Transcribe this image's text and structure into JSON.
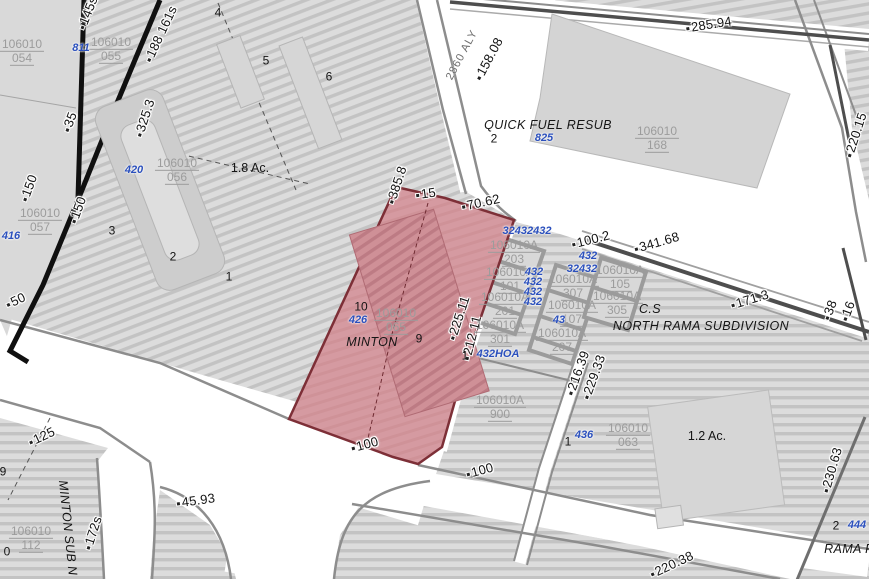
{
  "map": {
    "colors": {
      "selected_fill": "#d59aa1",
      "selected_hatch": "#c8888f",
      "selected_border": "#7d2f37",
      "parcel_fill": "#dcdcdc",
      "hatch_line": "#c3c3c3",
      "building_fill": "#d4d4d4",
      "road_white": "#ffffff",
      "road_casing": "#8d8d8d",
      "road_core": "#4e4e4e",
      "boundary_black": "#101010",
      "address_text": "#2b50bd",
      "parcel_id_text": "#9c9c9c",
      "dimension_text": "#141414"
    },
    "selected_parcel": {
      "parcel_id": "106010 065",
      "subdivision": "MINTON",
      "address": "426"
    },
    "labels": [
      {
        "name": "dim-145s",
        "type": "dim",
        "text": "145s",
        "x": 88,
        "y": 13,
        "rot": -68
      },
      {
        "name": "dim-188-161s",
        "type": "dim",
        "text": "188 161s",
        "x": 161,
        "y": 34,
        "rot": -65
      },
      {
        "name": "dim-325-3",
        "type": "dim",
        "text": "325.3",
        "x": 145,
        "y": 118,
        "rot": -72
      },
      {
        "name": "dim-35",
        "type": "dim",
        "text": "35",
        "x": 70,
        "y": 122,
        "rot": -70
      },
      {
        "name": "dim-150-a",
        "type": "dim",
        "text": "150",
        "x": 29,
        "y": 188,
        "rot": -70
      },
      {
        "name": "dim-150-b",
        "type": "dim",
        "text": "150",
        "x": 78,
        "y": 210,
        "rot": -70
      },
      {
        "name": "dim-50",
        "type": "dim",
        "text": "50",
        "x": 16,
        "y": 301,
        "rot": -25
      },
      {
        "name": "dim-125",
        "type": "dim",
        "text": "125",
        "x": 42,
        "y": 437,
        "rot": -25
      },
      {
        "name": "dim-45-93",
        "type": "dim",
        "text": "45.93",
        "x": 196,
        "y": 501,
        "rot": -8
      },
      {
        "name": "dim-172s",
        "type": "dim",
        "text": "172s",
        "x": 93,
        "y": 533,
        "rot": -72
      },
      {
        "name": "dim-385-8",
        "type": "dim",
        "text": "385.8",
        "x": 397,
        "y": 185,
        "rot": -72
      },
      {
        "name": "dim-15",
        "type": "dim",
        "text": "15",
        "x": 426,
        "y": 194,
        "rot": -8
      },
      {
        "name": "dim-70-62",
        "type": "dim",
        "text": "70.62",
        "x": 481,
        "y": 203,
        "rot": -12
      },
      {
        "name": "dim-225-11",
        "type": "dim",
        "text": "225.11",
        "x": 459,
        "y": 318,
        "rot": -72
      },
      {
        "name": "dim-212-11",
        "type": "dim",
        "text": "212.11",
        "x": 472,
        "y": 338,
        "rot": -76
      },
      {
        "name": "dim-100-red",
        "type": "dim",
        "text": "100",
        "x": 365,
        "y": 445,
        "rot": -15
      },
      {
        "name": "dim-100-b",
        "type": "dim",
        "text": "100",
        "x": 480,
        "y": 471,
        "rot": -15
      },
      {
        "name": "dim-158-08",
        "type": "dim",
        "text": "158.08",
        "x": 489,
        "y": 59,
        "rot": -62
      },
      {
        "name": "dim-285-94",
        "type": "dim",
        "text": "285.94",
        "x": 709,
        "y": 25,
        "rot": -9
      },
      {
        "name": "dim-220-15",
        "type": "dim",
        "text": "220.15",
        "x": 856,
        "y": 135,
        "rot": -72
      },
      {
        "name": "dim-100-2",
        "type": "dim",
        "text": "100.2",
        "x": 591,
        "y": 240,
        "rot": -14
      },
      {
        "name": "dim-341-68",
        "type": "dim",
        "text": "341.68",
        "x": 657,
        "y": 243,
        "rot": -16
      },
      {
        "name": "dim-171-3",
        "type": "dim",
        "text": "171.3",
        "x": 750,
        "y": 300,
        "rot": -17
      },
      {
        "name": "dim-38",
        "type": "dim",
        "text": "38",
        "x": 830,
        "y": 310,
        "rot": -70
      },
      {
        "name": "dim-16",
        "type": "dim",
        "text": "16",
        "x": 848,
        "y": 311,
        "rot": -70
      },
      {
        "name": "dim-216-39",
        "type": "dim",
        "text": "216.39",
        "x": 578,
        "y": 373,
        "rot": -70
      },
      {
        "name": "dim-229-33",
        "type": "dim",
        "text": "229.33",
        "x": 594,
        "y": 377,
        "rot": -70
      },
      {
        "name": "dim-230-63",
        "type": "dim",
        "text": "230.63",
        "x": 832,
        "y": 470,
        "rot": -74
      },
      {
        "name": "dim-220-38",
        "type": "dim",
        "text": "220.38",
        "x": 672,
        "y": 565,
        "rot": -25
      },
      {
        "name": "parcel-id-054",
        "type": "parcel-id",
        "text": "106010",
        "text2": "054",
        "x": 22,
        "y": 52,
        "rot": 0
      },
      {
        "name": "parcel-id-055",
        "type": "parcel-id",
        "text": "106010",
        "text2": "055",
        "x": 111,
        "y": 50,
        "rot": 0
      },
      {
        "name": "parcel-id-057",
        "type": "parcel-id",
        "text": "106010",
        "text2": "057",
        "x": 40,
        "y": 221,
        "rot": 0
      },
      {
        "name": "parcel-id-056",
        "type": "parcel-id",
        "text": "106010",
        "text2": "056",
        "x": 177,
        "y": 171,
        "rot": 0
      },
      {
        "name": "parcel-id-065-selected",
        "type": "parcel-id",
        "text": "106010",
        "text2": "065",
        "x": 396,
        "y": 321,
        "rot": 0
      },
      {
        "name": "parcel-id-168",
        "type": "parcel-id",
        "text": "106010",
        "text2": "168",
        "x": 657,
        "y": 139,
        "rot": 0
      },
      {
        "name": "parcel-id-063",
        "type": "parcel-id",
        "text": "106010",
        "text2": "063",
        "x": 628,
        "y": 436,
        "rot": 0
      },
      {
        "name": "parcel-id-112",
        "type": "parcel-id",
        "text": "106010",
        "text2": "112",
        "x": 31,
        "y": 539,
        "rot": 0
      },
      {
        "name": "parcel-id-203",
        "type": "parcel-id",
        "text": "106010A",
        "text2": "203",
        "x": 514,
        "y": 253,
        "rot": 0
      },
      {
        "name": "parcel-id-101",
        "type": "parcel-id",
        "text": "106010A",
        "text2": "101",
        "x": 510,
        "y": 280,
        "rot": 0
      },
      {
        "name": "parcel-id-201",
        "type": "parcel-id",
        "text": "106010A",
        "text2": "201",
        "x": 505,
        "y": 305,
        "rot": 0
      },
      {
        "name": "parcel-id-301",
        "type": "parcel-id",
        "text": "106010A",
        "text2": "301",
        "x": 500,
        "y": 333,
        "rot": 0
      },
      {
        "name": "parcel-id-307",
        "type": "parcel-id",
        "text": "106010A",
        "text2": "307",
        "x": 573,
        "y": 287,
        "rot": 0
      },
      {
        "name": "parcel-id-107",
        "type": "parcel-id",
        "text": "106010A",
        "text2": "107",
        "x": 572,
        "y": 313,
        "rot": 0
      },
      {
        "name": "parcel-id-207",
        "type": "parcel-id",
        "text": "106010A",
        "text2": "207",
        "x": 562,
        "y": 341,
        "rot": 0
      },
      {
        "name": "parcel-id-105",
        "type": "parcel-id",
        "text": "106010A",
        "text2": "105",
        "x": 620,
        "y": 278,
        "rot": 0
      },
      {
        "name": "parcel-id-305",
        "type": "parcel-id",
        "text": "106010A",
        "text2": "305",
        "x": 617,
        "y": 304,
        "rot": 0
      },
      {
        "name": "parcel-id-900",
        "type": "parcel-id",
        "text": "106010A",
        "text2": "900",
        "x": 500,
        "y": 408,
        "rot": 0
      },
      {
        "name": "address-811",
        "type": "addr",
        "text": "811",
        "x": 81,
        "y": 48,
        "rot": 0
      },
      {
        "name": "address-416",
        "type": "addr",
        "text": "416",
        "x": 11,
        "y": 236,
        "rot": 0
      },
      {
        "name": "address-420",
        "type": "addr",
        "text": "420",
        "x": 134,
        "y": 170,
        "rot": 0
      },
      {
        "name": "address-426",
        "type": "addr",
        "text": "426",
        "x": 358,
        "y": 320,
        "rot": 0
      },
      {
        "name": "address-825",
        "type": "addr",
        "text": "825",
        "x": 544,
        "y": 138,
        "rot": 0
      },
      {
        "name": "address-32432432",
        "type": "addr",
        "text": "32432432",
        "x": 527,
        "y": 231,
        "rot": 0
      },
      {
        "name": "address-432-a",
        "type": "addr",
        "text": "432",
        "x": 534,
        "y": 272,
        "rot": 0
      },
      {
        "name": "address-432-b",
        "type": "addr",
        "text": "432",
        "x": 533,
        "y": 282,
        "rot": 0
      },
      {
        "name": "address-432-c",
        "type": "addr",
        "text": "432",
        "x": 533,
        "y": 292,
        "rot": 0
      },
      {
        "name": "address-432-d",
        "type": "addr",
        "text": "432",
        "x": 533,
        "y": 302,
        "rot": 0
      },
      {
        "name": "address-432-e",
        "type": "addr",
        "text": "432",
        "x": 588,
        "y": 256,
        "rot": 0
      },
      {
        "name": "address-32432",
        "type": "addr",
        "text": "32432",
        "x": 582,
        "y": 269,
        "rot": 0
      },
      {
        "name": "address-43",
        "type": "addr",
        "text": "43",
        "x": 559,
        "y": 320,
        "rot": 0
      },
      {
        "name": "address-432hoa",
        "type": "addr",
        "text": "432HOA",
        "x": 498,
        "y": 354,
        "rot": 0
      },
      {
        "name": "address-436",
        "type": "addr",
        "text": "436",
        "x": 584,
        "y": 435,
        "rot": 0
      },
      {
        "name": "address-444",
        "type": "addr",
        "text": "444",
        "x": 857,
        "y": 525,
        "rot": 0
      },
      {
        "name": "lot-4",
        "type": "lot",
        "text": "4",
        "x": 218,
        "y": 13,
        "rot": 0
      },
      {
        "name": "lot-5",
        "type": "lot",
        "text": "5",
        "x": 266,
        "y": 61,
        "rot": 0
      },
      {
        "name": "lot-6",
        "type": "lot",
        "text": "6",
        "x": 329,
        "y": 77,
        "rot": 0
      },
      {
        "name": "lot-3",
        "type": "lot",
        "text": "3",
        "x": 112,
        "y": 231,
        "rot": 0
      },
      {
        "name": "lot-2",
        "type": "lot",
        "text": "2",
        "x": 173,
        "y": 257,
        "rot": 0
      },
      {
        "name": "lot-1-a",
        "type": "lot",
        "text": "1",
        "x": 229,
        "y": 277,
        "rot": 0
      },
      {
        "name": "lot-10",
        "type": "lot",
        "text": "10",
        "x": 361,
        "y": 307,
        "rot": 0
      },
      {
        "name": "lot-9",
        "type": "lot",
        "text": "9",
        "x": 419,
        "y": 339,
        "rot": 0
      },
      {
        "name": "lot-1-b",
        "type": "lot",
        "text": "1",
        "x": 465,
        "y": 356,
        "rot": 0
      },
      {
        "name": "lot-1-c",
        "type": "lot",
        "text": "1",
        "x": 568,
        "y": 442,
        "rot": 0
      },
      {
        "name": "lot-2-quickfuel",
        "type": "lot",
        "text": "2",
        "x": 494,
        "y": 139,
        "rot": 0
      },
      {
        "name": "lot-2-rama",
        "type": "lot",
        "text": "2",
        "x": 836,
        "y": 526,
        "rot": 0
      },
      {
        "name": "lot-9-edge",
        "type": "lot",
        "text": "9",
        "x": 3,
        "y": 472,
        "rot": 0
      },
      {
        "name": "lot-0-edge",
        "type": "lot",
        "text": "0",
        "x": 7,
        "y": 552,
        "rot": 0
      },
      {
        "name": "subdivision-quick-fuel-resub",
        "type": "sub",
        "text": "QUICK FUEL RESUB",
        "x": 548,
        "y": 126,
        "rot": 0
      },
      {
        "name": "subdivision-north-rama",
        "type": "sub",
        "text": "NORTH RAMA SUBDIVISION",
        "x": 701,
        "y": 327,
        "rot": 0
      },
      {
        "name": "subdivision-minton",
        "type": "sub",
        "text": "MINTON",
        "x": 372,
        "y": 343,
        "rot": 0
      },
      {
        "name": "subdivision-minton-sub-n",
        "type": "sub",
        "text": "MINTON SUB N",
        "x": 67,
        "y": 528,
        "rot": 84
      },
      {
        "name": "subdivision-rama-p",
        "type": "sub",
        "text": "RAMA P",
        "x": 849,
        "y": 550,
        "rot": 0
      },
      {
        "name": "annotation-cs",
        "type": "sub",
        "text": "C.S",
        "x": 650,
        "y": 310,
        "rot": 0
      },
      {
        "name": "area-1-8-ac",
        "type": "area",
        "text": "1.8 Ac.",
        "x": 250,
        "y": 169,
        "rot": 0
      },
      {
        "name": "area-1-2-ac",
        "type": "area",
        "text": "1.2 Ac.",
        "x": 707,
        "y": 437,
        "rot": 0
      },
      {
        "name": "road-2860-aly",
        "type": "road",
        "text": "2860 ALY",
        "x": 462,
        "y": 55,
        "rot": -62
      }
    ]
  }
}
